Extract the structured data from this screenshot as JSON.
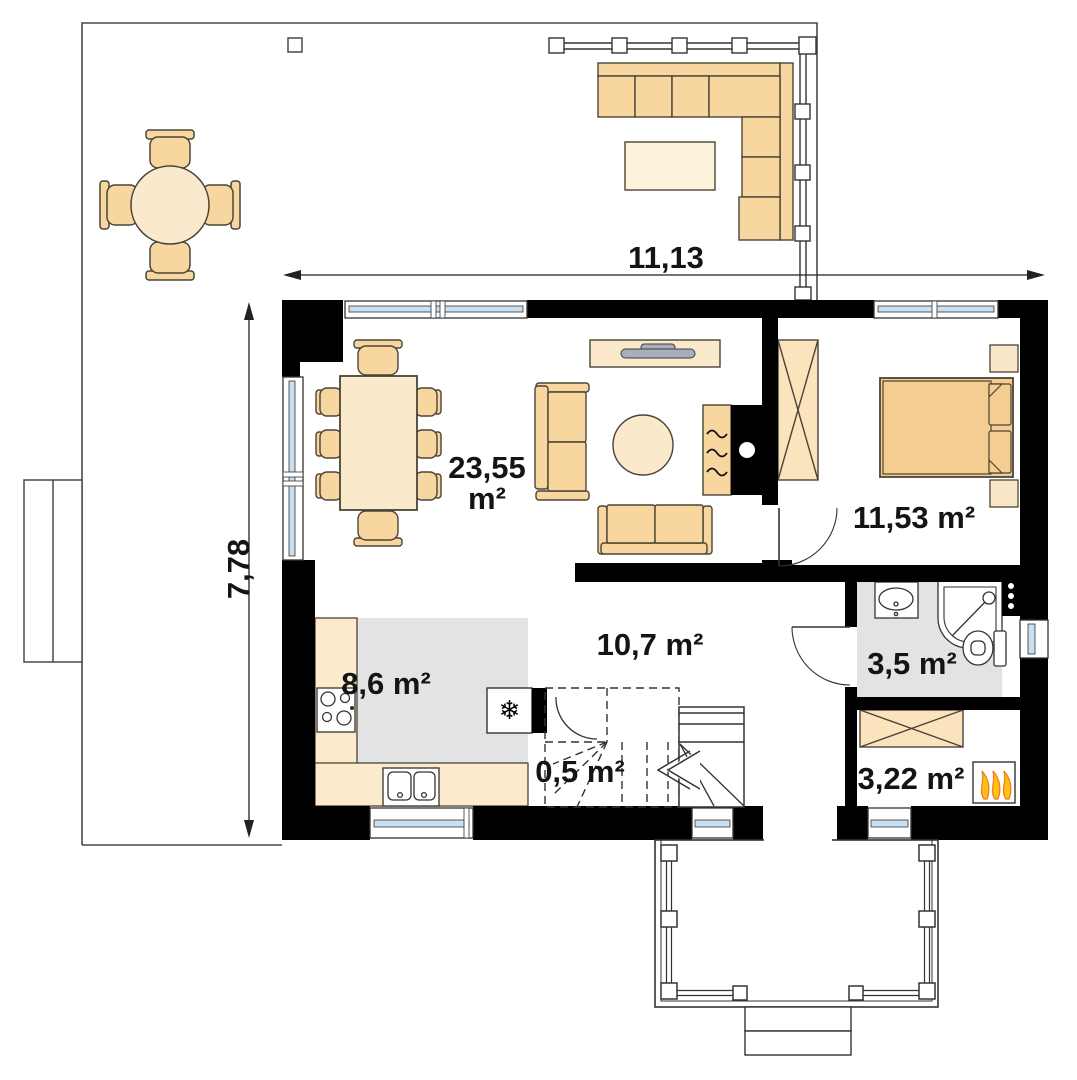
{
  "title": "House ground floor plan",
  "dimensions": {
    "width_label": "11,13",
    "height_label": "7,78"
  },
  "rooms": {
    "living": {
      "area_value": "23,55",
      "area_unit": "m²"
    },
    "bedroom": {
      "area": "11,53 m²"
    },
    "hall": {
      "area": "10,7 m²"
    },
    "kitchen": {
      "area": "8,6 m²"
    },
    "closet": {
      "area": "0,5 m²"
    },
    "bathroom": {
      "area": "3,5 m²"
    },
    "utility": {
      "area": "3,22 m²"
    }
  },
  "icons": {
    "fridge_snowflake": "❄"
  },
  "colors": {
    "wall": "#000000",
    "furniture_light": "#FBE9CB",
    "furniture_accent": "#F8D6A0",
    "bed": "#F5CD90",
    "floor_gray": "#E3E3E3",
    "window_glass": "#C9DFF2",
    "flame_yellow": "#FFC117",
    "flame_orange": "#EE7F1B",
    "tv_gray": "#A6B0BA",
    "outline": "#4a4437"
  }
}
